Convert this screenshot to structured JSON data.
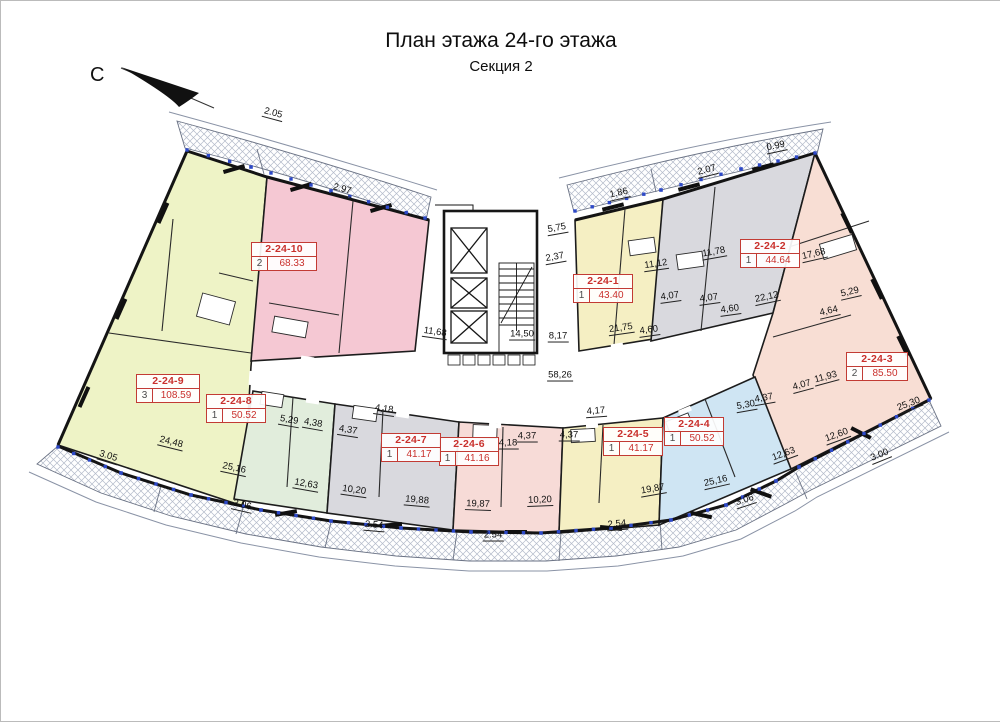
{
  "title": "План этажа 24-го этажа",
  "subtitle": "Секция 2",
  "north_label": "С",
  "apartments": [
    {
      "id": "2-24-1",
      "rooms": "1",
      "area": "43.40",
      "color": "#f5efc3"
    },
    {
      "id": "2-24-2",
      "rooms": "1",
      "area": "44.64",
      "color": "#d9d9de"
    },
    {
      "id": "2-24-3",
      "rooms": "2",
      "area": "85.50",
      "color": "#f8ded4"
    },
    {
      "id": "2-24-4",
      "rooms": "1",
      "area": "50.52",
      "color": "#cfe5f3"
    },
    {
      "id": "2-24-5",
      "rooms": "1",
      "area": "41.17",
      "color": "#f5efc3"
    },
    {
      "id": "2-24-6",
      "rooms": "1",
      "area": "41.16",
      "color": "#f7dbd7"
    },
    {
      "id": "2-24-7",
      "rooms": "1",
      "area": "41.17",
      "color": "#d9d9de"
    },
    {
      "id": "2-24-8",
      "rooms": "1",
      "area": "50.52",
      "color": "#e1eddc"
    },
    {
      "id": "2-24-9",
      "rooms": "3",
      "area": "108.59",
      "color": "#eef3c6"
    },
    {
      "id": "2-24-10",
      "rooms": "2",
      "area": "68.33",
      "color": "#f5c8d3"
    }
  ],
  "dimensions": [
    "2.05",
    "2.97",
    "1.86",
    "2.07",
    "0.99",
    "3.05",
    "24,48",
    "25,16",
    "3.06",
    "12,63",
    "10,20",
    "19,88",
    "2.54",
    "19,87",
    "10,20",
    "2.54",
    "2.54",
    "19,87",
    "25,16",
    "3.06",
    "12,63",
    "12,60",
    "3.00",
    "25,30",
    "5,29",
    "4,38",
    "4,37",
    "4,18",
    "4,18",
    "4,37",
    "4,37",
    "4,17",
    "5,30",
    "4,37",
    "4,07",
    "11,93",
    "58,26",
    "11,68",
    "14,50",
    "8,17",
    "5,75",
    "2,37",
    "21,75",
    "4,60",
    "11,12",
    "4,07",
    "11,78",
    "4,07",
    "4,60",
    "22,12",
    "17,68",
    "5,29",
    "4,64"
  ]
}
